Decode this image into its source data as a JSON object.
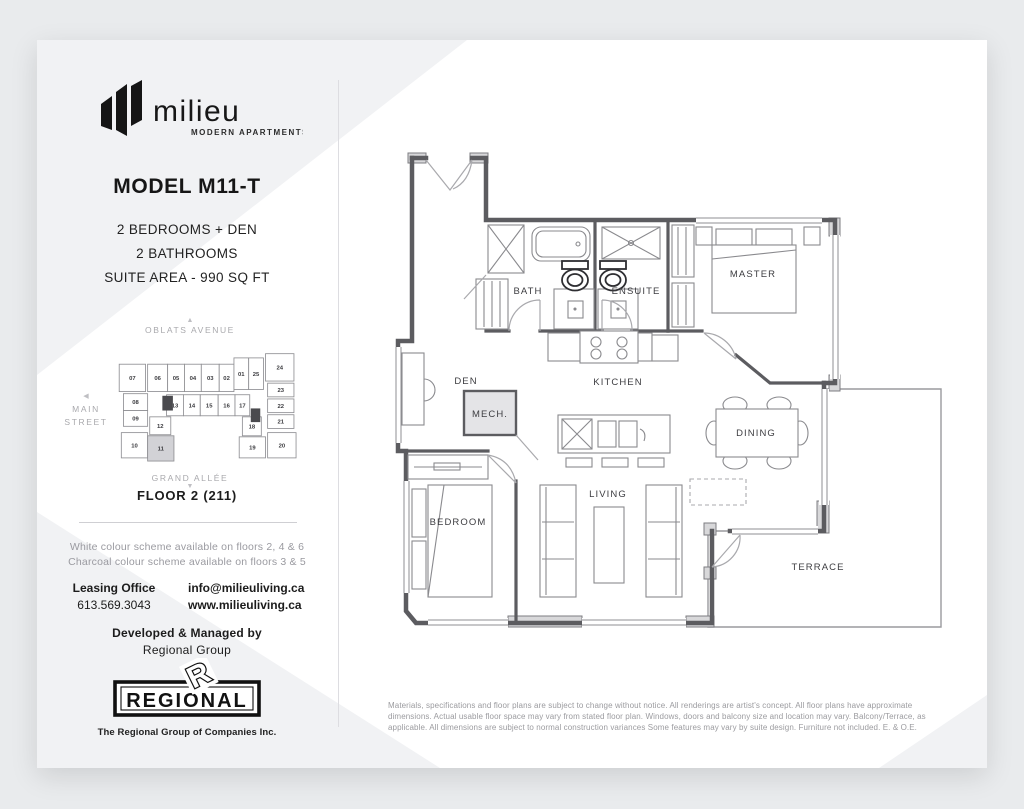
{
  "brand": {
    "name": "milieu",
    "tagline": "MODERN APARTMENTS"
  },
  "model": {
    "title": "MODEL M11-T",
    "specs": [
      "2 BEDROOMS + DEN",
      "2 BATHROOMS",
      "SUITE AREA - 990 SQ FT"
    ]
  },
  "keyplan": {
    "streets": {
      "top": "OBLATS AVENUE",
      "left_line1": "MAIN",
      "left_line2": "STREET",
      "bottom": "GRAND ALLÉE"
    },
    "arrows": {
      "up": "▲",
      "left": "◀",
      "down": "▼"
    },
    "highlight_unit": "11",
    "highlight_color": "#d2d2d6",
    "units": [
      {
        "label": "07",
        "x": 4,
        "y": 14,
        "w": 25,
        "h": 26
      },
      {
        "label": "06",
        "x": 31,
        "y": 14,
        "w": 19,
        "h": 26
      },
      {
        "label": "05",
        "x": 50,
        "y": 14,
        "w": 16,
        "h": 26
      },
      {
        "label": "04",
        "x": 66,
        "y": 14,
        "w": 16,
        "h": 26
      },
      {
        "label": "03",
        "x": 82,
        "y": 14,
        "w": 17,
        "h": 26
      },
      {
        "label": "02",
        "x": 99,
        "y": 14,
        "w": 14,
        "h": 26
      },
      {
        "label": "01",
        "x": 113,
        "y": 8,
        "w": 14,
        "h": 30
      },
      {
        "label": "25",
        "x": 127,
        "y": 8,
        "w": 14,
        "h": 30
      },
      {
        "label": "24",
        "x": 143,
        "y": 4,
        "w": 27,
        "h": 26
      },
      {
        "label": "23",
        "x": 145,
        "y": 32,
        "w": 25,
        "h": 13
      },
      {
        "label": "22",
        "x": 145,
        "y": 47,
        "w": 25,
        "h": 13
      },
      {
        "label": "21",
        "x": 145,
        "y": 62,
        "w": 25,
        "h": 13
      },
      {
        "label": "20",
        "x": 145,
        "y": 79,
        "w": 27,
        "h": 24
      },
      {
        "label": "08",
        "x": 8,
        "y": 42,
        "w": 23,
        "h": 16
      },
      {
        "label": "09",
        "x": 8,
        "y": 58,
        "w": 23,
        "h": 15
      },
      {
        "label": "10",
        "x": 6,
        "y": 79,
        "w": 25,
        "h": 24
      },
      {
        "label": "13",
        "x": 49,
        "y": 43,
        "w": 16,
        "h": 20
      },
      {
        "label": "14",
        "x": 65,
        "y": 43,
        "w": 16,
        "h": 20
      },
      {
        "label": "15",
        "x": 81,
        "y": 43,
        "w": 17,
        "h": 20
      },
      {
        "label": "16",
        "x": 98,
        "y": 43,
        "w": 16,
        "h": 20
      },
      {
        "label": "17",
        "x": 114,
        "y": 43,
        "w": 14,
        "h": 20
      },
      {
        "label": "12",
        "x": 33,
        "y": 64,
        "w": 20,
        "h": 17
      },
      {
        "label": "11",
        "x": 31,
        "y": 82,
        "w": 25,
        "h": 24,
        "hl": true
      },
      {
        "label": "18",
        "x": 121,
        "y": 64,
        "w": 18,
        "h": 18
      },
      {
        "label": "19",
        "x": 118,
        "y": 83,
        "w": 25,
        "h": 20
      }
    ]
  },
  "floor": {
    "label": "FLOOR 2 (211)"
  },
  "notes": [
    "White colour scheme available on floors 2, 4 & 6",
    "Charcoal colour scheme available on floors 3 & 5"
  ],
  "contact": {
    "office_label": "Leasing Office",
    "phone": "613.569.3043",
    "email": "info@milieuliving.ca",
    "website": "www.milieuliving.ca"
  },
  "developer": {
    "line1": "Developed & Managed by",
    "line2": "Regional Group",
    "logo_text": "REGIONAL",
    "logo_r": "R",
    "logo_caption": "The Regional Group of Companies Inc."
  },
  "floorplan": {
    "rooms": [
      {
        "name": "BATH",
        "x": 138,
        "y": 161
      },
      {
        "name": "ENSUITE",
        "x": 246,
        "y": 161
      },
      {
        "name": "MASTER",
        "x": 363,
        "y": 144
      },
      {
        "name": "DEN",
        "x": 76,
        "y": 251
      },
      {
        "name": "KITCHEN",
        "x": 228,
        "y": 252
      },
      {
        "name": "MECH.",
        "x": 100,
        "y": 284
      },
      {
        "name": "DINING",
        "x": 366,
        "y": 303
      },
      {
        "name": "BEDROOM",
        "x": 68,
        "y": 392
      },
      {
        "name": "LIVING",
        "x": 218,
        "y": 364
      },
      {
        "name": "TERRACE",
        "x": 428,
        "y": 437
      }
    ]
  },
  "disclaimer": "Materials, specifications and floor plans are subject to change without notice. All renderings are artist's concept. All floor plans have approximate dimensions. Actual usable floor space may vary from stated floor plan. Windows, doors and balcony size and location may vary. Balcony/Terrace, as applicable. All dimensions are subject to normal construction variances Some features may vary by suite design. Furniture not included. E. & O.E."
}
